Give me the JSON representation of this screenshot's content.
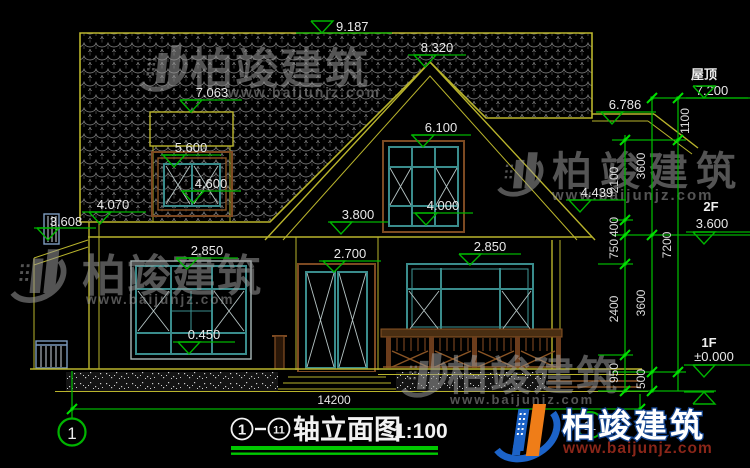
{
  "drawing_title": {
    "axis_from": "1",
    "axis_to": "11",
    "name": "轴立面图",
    "scale": "1:100"
  },
  "axes": {
    "left_bubble": "1",
    "right_bubble": "11"
  },
  "overall_dim": "14200",
  "elevation_levels": {
    "ridge": "9.187",
    "gable_peak": "8.320",
    "dormer_top": "7.063",
    "right_eave": "6.786",
    "gable_window_top": "6.100",
    "dormer_window_top": "5.600",
    "dormer_window_sill": "4.600",
    "right_eave_bottom": "4.439",
    "left_eave": "4.070",
    "second_floor_mark": "3.800",
    "left_canopy": "3.608",
    "window_left_top": "2.850",
    "door_top": "2.700",
    "window_right_top": "2.850",
    "window_sill": "0.450"
  },
  "floor_levels": [
    {
      "floor": "屋顶",
      "value": "7.200"
    },
    {
      "floor": "2F",
      "value": "3.600"
    },
    {
      "floor": "1F",
      "value": "±0.000"
    }
  ],
  "vertical_dims": {
    "inner": [
      "2100",
      "400",
      "750",
      "2400",
      "950"
    ],
    "middle": [
      "3600",
      "3600",
      "500"
    ],
    "outer": [
      "1100",
      "7200"
    ]
  },
  "watermark": {
    "brand": "柏竣建筑",
    "url": "www.baijunjz.com"
  },
  "logo": {
    "brand": "柏竣建筑",
    "url": "www.baijunjz.com"
  }
}
